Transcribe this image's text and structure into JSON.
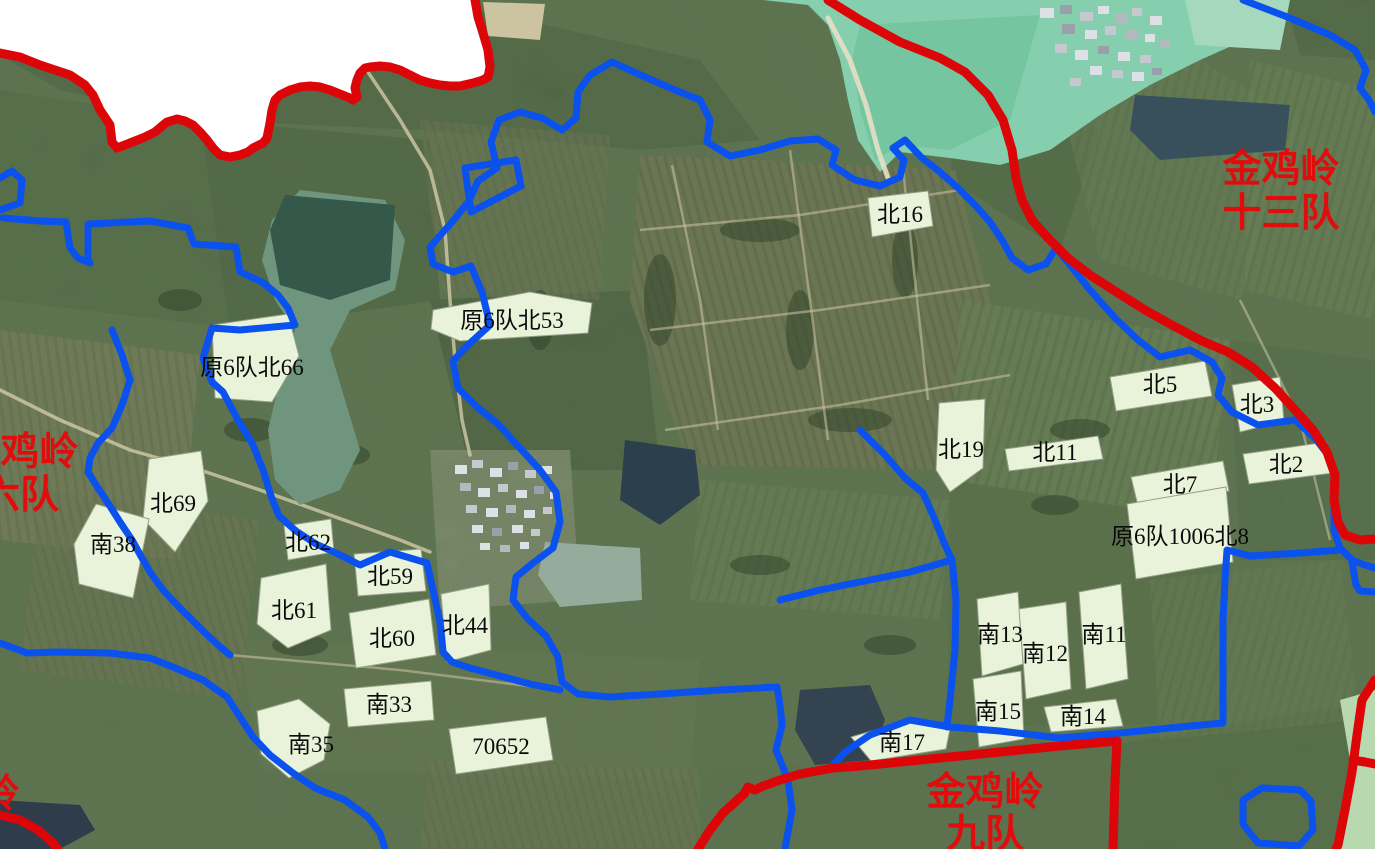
{
  "map": {
    "region_labels": [
      {
        "lines": [
          "金鸡岭",
          "十三队"
        ],
        "x": 1281,
        "y": 182,
        "line_height": 44
      },
      {
        "lines": [
          "金鸡岭",
          "六队"
        ],
        "x": 20,
        "y": 465,
        "line_height": 43
      },
      {
        "lines": [
          "金鸡岭",
          "九队"
        ],
        "x": 985,
        "y": 805,
        "line_height": 42
      },
      {
        "lines": [
          "岭"
        ],
        "x": 0,
        "y": 807,
        "line_height": 40
      }
    ],
    "parcels": [
      {
        "label": "原6队北66",
        "points": "212,325 288,314 299,356 272,402 215,398",
        "label_x": 252,
        "label_y": 375
      },
      {
        "label": "原6队北53",
        "points": "433,310 530,292 592,303 588,333 460,341 431,329",
        "label_x": 512,
        "label_y": 328
      },
      {
        "label": "北16",
        "points": "868,198 928,191 933,226 872,237",
        "label_x": 900,
        "label_y": 222
      },
      {
        "label": "北5",
        "points": "1110,377 1205,361 1212,396 1116,411",
        "label_x": 1160,
        "label_y": 392
      },
      {
        "label": "北3",
        "points": "1232,385 1280,377 1284,421 1240,432",
        "label_x": 1257,
        "label_y": 412
      },
      {
        "label": "北19",
        "points": "939,403 985,399 983,468 950,492 936,470",
        "label_x": 961,
        "label_y": 457
      },
      {
        "label": "北11",
        "points": "1005,449 1098,436 1103,459 1009,471",
        "label_x": 1055,
        "label_y": 460
      },
      {
        "label": "北2",
        "points": "1243,454 1326,442 1333,473 1249,484",
        "label_x": 1286,
        "label_y": 472
      },
      {
        "label": "北7",
        "points": "1131,477 1223,461 1229,491 1138,506",
        "label_x": 1180,
        "label_y": 492
      },
      {
        "label": "原6队1006北8",
        "points": "1127,504 1226,487 1233,562 1136,579",
        "label_x": 1180,
        "label_y": 544
      },
      {
        "label": "北69",
        "points": "149,459 201,451 208,501 175,552 143,519",
        "label_x": 173,
        "label_y": 511
      },
      {
        "label": "南38",
        "points": "96,504 149,519 133,598 79,584 74,544",
        "label_x": 113,
        "label_y": 552
      },
      {
        "label": "北62",
        "points": "284,526 331,519 334,552 288,560",
        "label_x": 308,
        "label_y": 550
      },
      {
        "label": "北59",
        "points": "354,554 421,549 426,591 358,596",
        "label_x": 390,
        "label_y": 584
      },
      {
        "label": "北61",
        "points": "261,578 326,564 331,630 288,648 257,624",
        "label_x": 294,
        "label_y": 618
      },
      {
        "label": "北60",
        "points": "349,613 429,599 436,655 356,668",
        "label_x": 392,
        "label_y": 646
      },
      {
        "label": "北44",
        "points": "441,594 489,584 491,650 447,662",
        "label_x": 465,
        "label_y": 633
      },
      {
        "label": "南33",
        "points": "344,689 431,681 434,720 348,727",
        "label_x": 389,
        "label_y": 712
      },
      {
        "label": "南35",
        "points": "257,711 299,699 330,724 324,760 289,778 261,754",
        "label_x": 311,
        "label_y": 752
      },
      {
        "label": "70652",
        "points": "449,729 546,717 553,760 456,774",
        "label_x": 501,
        "label_y": 754
      },
      {
        "label": "南13",
        "points": "977,599 1018,592 1023,664 982,676",
        "label_x": 1000,
        "label_y": 642
      },
      {
        "label": "南12",
        "points": "1019,609 1066,602 1071,689 1026,699",
        "label_x": 1045,
        "label_y": 661
      },
      {
        "label": "南11",
        "points": "1079,592 1121,584 1128,679 1086,689",
        "label_x": 1104,
        "label_y": 642
      },
      {
        "label": "南15",
        "points": "973,679 1021,671 1024,739 979,747",
        "label_x": 998,
        "label_y": 719
      },
      {
        "label": "南14",
        "points": "1044,707 1116,699 1123,726 1051,732",
        "label_x": 1083,
        "label_y": 724
      },
      {
        "label": "南17",
        "points": "851,737 906,721 951,724 946,749 871,761",
        "label_x": 902,
        "label_y": 750
      }
    ],
    "boundaries": {
      "red": [
        {
          "name": "nw-no-data-edge",
          "points": "0,53 20,57 40,65 55,70 70,75 85,85 93,95 100,110 110,125 112,142 117,148 130,143 145,137 155,132 167,122 177,119 185,121 193,125 200,132 207,140 213,148 220,155 230,157 240,155 248,152 253,148 263,143 267,138 270,123 272,110 275,100 280,95 290,90 300,87 310,86 320,87 330,90 340,94 350,98 353,100 357,97 355,88 357,80 360,73 365,68 370,67 380,66 390,67 400,70 410,75 420,80 430,83 440,85 450,86 460,86 473,83 483,80 488,77 490,67 488,50 483,33 478,17 475,0"
        },
        {
          "name": "east-team-line",
          "points": "828,0 860,20 900,42 940,58 965,72 988,95 1003,120 1012,150 1016,178 1022,200 1032,220 1048,238 1068,258 1090,275 1118,293 1145,310 1172,325 1200,340 1228,352 1252,367 1275,388 1295,410 1313,430 1327,452 1335,475 1334,500 1338,522 1345,535 1360,540 1375,539"
        },
        {
          "name": "south-team-line",
          "points": "1117,741 1060,746 1000,752 950,757 900,762 860,766 833,768 800,774 780,780 763,786 755,790 748,787 744,794 723,813 710,830 698,849"
        },
        {
          "name": "south-branch",
          "points": "1117,741 1115,780 1114,815 1113,849"
        },
        {
          "name": "se-corner-line",
          "points": "1375,680 1362,700 1357,735 1352,772 1345,810 1338,845 1336,849"
        },
        {
          "name": "se-spur",
          "points": "1353,760 1365,762 1375,764"
        },
        {
          "name": "sw-corner-line",
          "points": "0,815 20,820 38,830 52,842 58,849"
        }
      ],
      "blue": [
        {
          "name": "west-loop",
          "points": "612,62 590,75 578,92 576,118 562,130 542,118 520,112 499,120 491,142 497,168 478,181 469,201 452,222 430,247 433,264 453,272 471,266 482,292 490,325 468,345 453,361 458,388 477,407 498,424 518,446 540,470 556,492 560,522 553,548 533,563 516,577 513,600 527,618 546,636 558,657 562,682 578,694 610,697 660,694 720,690 777,687"
        },
        {
          "name": "east-loop",
          "points": "612,62 645,77 675,90 700,100 710,120 707,142 730,156 760,150 790,141 818,139 836,150 832,165 855,180 880,186 900,177 904,160 893,148 905,140 922,158 940,172 958,188 975,205 990,222 1002,240 1012,258 1028,270 1046,264 1056,248 1070,265 1090,290 1115,318 1138,340 1160,357 1190,350 1212,362 1222,378 1218,395 1232,412 1258,425 1280,422 1295,420 1315,438 1328,455 1334,470 1334,530 1340,548 1352,560 1365,565 1375,568"
        },
        {
          "name": "south-link",
          "points": "1340,550 1300,553 1250,556 1227,550 1225,580 1223,620 1223,680 1223,723 1180,727 1120,733 1060,738 1000,731 950,727 910,720 870,735 845,752 830,768"
        },
        {
          "name": "mid-vertical",
          "points": "780,600 820,590 870,580 910,572 952,560 956,600 955,650 950,700 947,727"
        },
        {
          "name": "pond-south",
          "points": "777,687 780,705 782,725 776,750 788,780 792,810 786,843 785,849"
        },
        {
          "name": "southwest-long",
          "points": "0,643 27,653 57,652 110,653 150,658 173,667 203,680 227,697 240,717 253,737 270,755 293,773 315,788 345,800 368,817 380,833 385,849"
        },
        {
          "name": "nw-edge-piece",
          "points": "0,178 12,171 22,180 20,203 0,210"
        },
        {
          "name": "nw-net-a",
          "points": "3,218 40,221 66,222 70,248 78,258 90,263"
        },
        {
          "name": "nw-net-b",
          "points": "88,262 88,224 150,221 188,228 194,244 236,247 240,272 262,282 278,295 288,308 295,325 240,330 212,328 203,358 212,382 223,392 238,420 253,445 263,470 271,496 279,516 296,531 316,544 338,554 360,565 390,552 427,563 433,590 440,622 443,652 452,662 470,668 500,676 530,684 560,690"
        },
        {
          "name": "west-descender",
          "points": "112,330 122,355 130,380 122,405 112,428 98,443 90,458 88,472 98,488 108,503 120,522 132,540 142,558 150,572 163,590 180,608 200,628 218,645 230,655"
        },
        {
          "name": "small-quad",
          "points": "465,168 516,160 521,186 471,212 465,168"
        },
        {
          "name": "topright-entry",
          "points": "1243,0 1290,18 1330,35 1355,50 1366,70 1360,88 1369,100 1375,112"
        },
        {
          "name": "right-edge-stub",
          "points": "1352,562 1356,585 1360,591 1375,592"
        },
        {
          "name": "corner-parcel-outline",
          "points": "1243,800 1262,788 1300,790 1311,801 1313,830 1299,846 1258,843 1243,824 1243,800"
        },
        {
          "name": "ne19-descender",
          "points": "860,430 885,455 905,478 923,493 935,520 945,545 952,560"
        }
      ]
    },
    "colors": {
      "parcel_fill": "#e9f3da",
      "red_boundary": "#dc0508",
      "blue_boundary": "#0b51ee",
      "label_red": "#e20c0c",
      "water_reservoir": "#85cfae"
    }
  }
}
